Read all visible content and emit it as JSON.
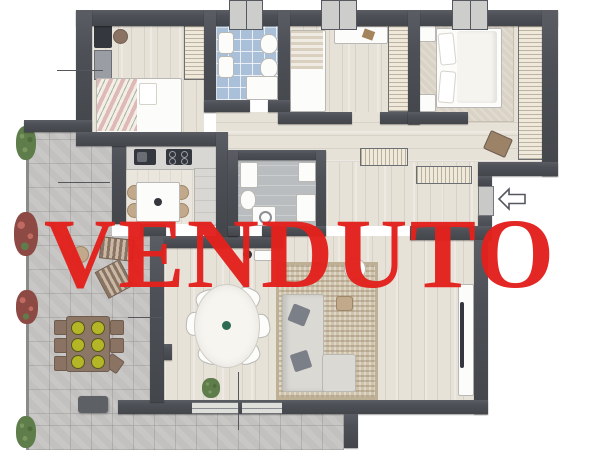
{
  "overlay": {
    "sold_label": "VENDUTO",
    "sold_color": "#e3211d"
  },
  "palette": {
    "wall": "#4d5056",
    "wood_floor": "#e7e2d8",
    "kitchen_floor": "#eae6dd",
    "blue_tile": "#a9c0d8",
    "bath_gray_floor": "#babdbf",
    "terrace_stone": "#c2c1bf",
    "rug": "#cfc3ab",
    "sofa": "#dbd9d4",
    "outdoor_wood": "#8c7666",
    "plant_green": "#5f7d4b",
    "plant_red": "#8d4a45",
    "sold": "#e3211d"
  },
  "icons": {
    "entrance_arrow": "left-arrow-outline"
  }
}
